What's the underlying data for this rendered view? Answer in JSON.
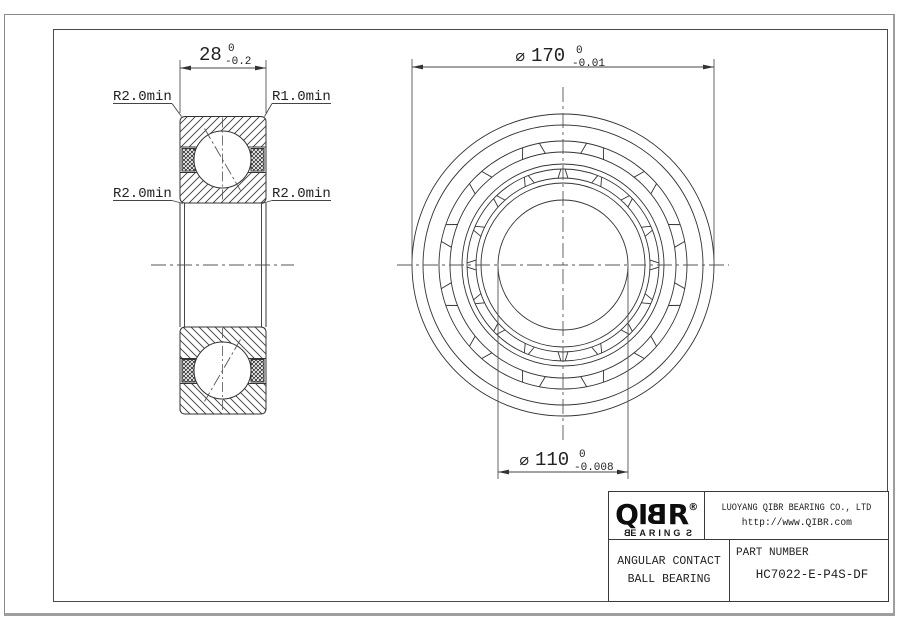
{
  "left_view": {
    "width_dim": {
      "value": "28",
      "tol_top": "0",
      "tol_bottom": "-0.2"
    },
    "labels": {
      "top_left": "R2.0min",
      "top_right": "R1.0min",
      "mid_left": "R2.0min",
      "mid_right": "R2.0min"
    }
  },
  "front_view": {
    "outer_dim": {
      "phi": "⌀",
      "value": "170",
      "tol_top": "0",
      "tol_bottom": "-0.01"
    },
    "bore_dim": {
      "phi": "⌀",
      "value": "110",
      "tol_top": "0",
      "tol_bottom": "-0.008"
    }
  },
  "title_block": {
    "logo": {
      "l1": "Q",
      "l2": "I",
      "l3": "B",
      "l4": "R",
      "reg": "®",
      "sub_b": "B",
      "sub_mid": "EARING",
      "sub_s": "S"
    },
    "company": "LUOYANG QIBR BEARING CO., LTD",
    "website": "http://www.QIBR.com",
    "product_line1": "ANGULAR CONTACT",
    "product_line2": "BALL BEARING",
    "part_number_label": "PART NUMBER",
    "part_number": "HC7022-E-P4S-DF"
  },
  "colors": {
    "line": "#333333",
    "dim": "#555555",
    "background": "#ffffff"
  }
}
